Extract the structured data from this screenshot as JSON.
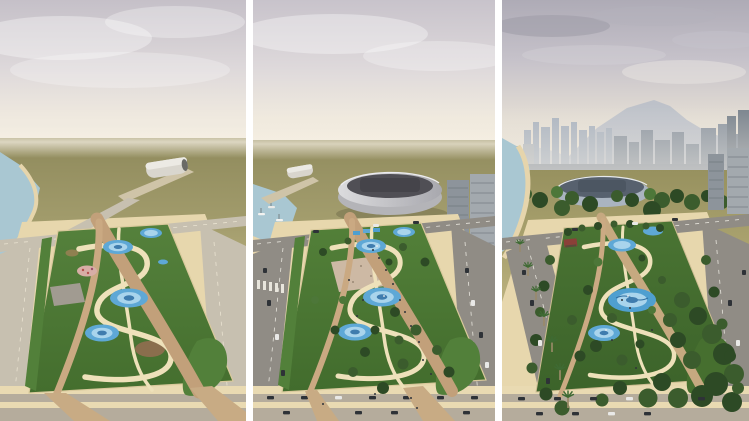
{
  "meta": {
    "kind": "architectural-render-triptych",
    "subject": "three-phase aerial rendering of a waterfront linear park development",
    "width_px": 749,
    "height_px": 421,
    "panel_count": 3
  },
  "panels": [
    {
      "id": "phase-1",
      "scene": [
        "hazy-sky",
        "barren-olive-plain",
        "coastline-left",
        "pier-vault-pavilion",
        "empty-boulevards",
        "new-linear-park",
        "winding-cream-paths",
        "tan-promenade",
        "blue-splash-pads",
        "pink-playground",
        "grey-plaza",
        "planting-beds"
      ]
    },
    {
      "id": "phase-2",
      "scene": [
        "hazy-sky",
        "olive-plain-horizon",
        "marina-with-boats",
        "beach-umbrellas",
        "white-arena",
        "pier-vault-pavilion",
        "waterfront-apartment-blocks",
        "boulevards-with-traffic",
        "crosswalk",
        "park-with-young-trees",
        "visitors",
        "splash-pads",
        "mural-plaza",
        "parked-cars"
      ]
    },
    {
      "id": "phase-3",
      "scene": [
        "cloudy-sky",
        "mountain-backdrop",
        "downtown-skyline",
        "dense-tree-canopy",
        "arena-screened-by-trees",
        "palm-lined-coastal-boulevard",
        "beach-cove",
        "mature-park-forest",
        "water-plaza",
        "red-roof-pavilion",
        "apartment-blocks-right",
        "street-trees",
        "parked-cars"
      ]
    }
  ],
  "colors": {
    "divider": "#ffffff",
    "sky_top": "#c5c0c8",
    "sky_mid": "#ddd8da",
    "horizon_glow": "#f3edde",
    "sky3_top": "#aeabb6",
    "ground_far": "#8f8a5c",
    "ground_mid": "#b2a977",
    "sand": "#e2d2a4",
    "apron": "#e7d7ad",
    "path": "#eee1ba",
    "promenade": "#c2a07a",
    "lawn": "#52803a",
    "lawn_dark": "#3f682c",
    "lawn3": "#466f2f",
    "water_pad": "#5ea8d6",
    "water_ring": "#a9d4ec",
    "water_deep": "#3f7cae",
    "sea": "#a9c7d2",
    "beach": "#e6d5ac",
    "road_light": "#c7c0b0",
    "road_asphalt": "#908c85",
    "road_line": "#f4f2ea",
    "stadium_body": "#cfd0d4",
    "stadium_roof": "#45444a",
    "stadium3": "#aab4c0",
    "stadium3_roof": "#57616e",
    "building": "#8d949b",
    "building_dark": "#6a7178",
    "building_light": "#a3a9ae",
    "skyline_far": "#aab3bf",
    "skyline_near": "#8c95a0",
    "mountain": "#b7bdc8",
    "tree_dark": "#2d4a25",
    "tree_mid": "#3b5c2d",
    "tree_light": "#4d7739",
    "palm_trunk": "#9a8a68",
    "car_dark": "#2e3237",
    "car_white": "#e9e9e7",
    "people": "#30343a",
    "playground_pink": "#d7aea6",
    "plaza_grey": "#a19b91",
    "bed_brown": "#8a6e4d",
    "pavilion_red": "#8a4038",
    "gravel": "#b5ac9c",
    "strip_sand": "#e9dab2"
  }
}
